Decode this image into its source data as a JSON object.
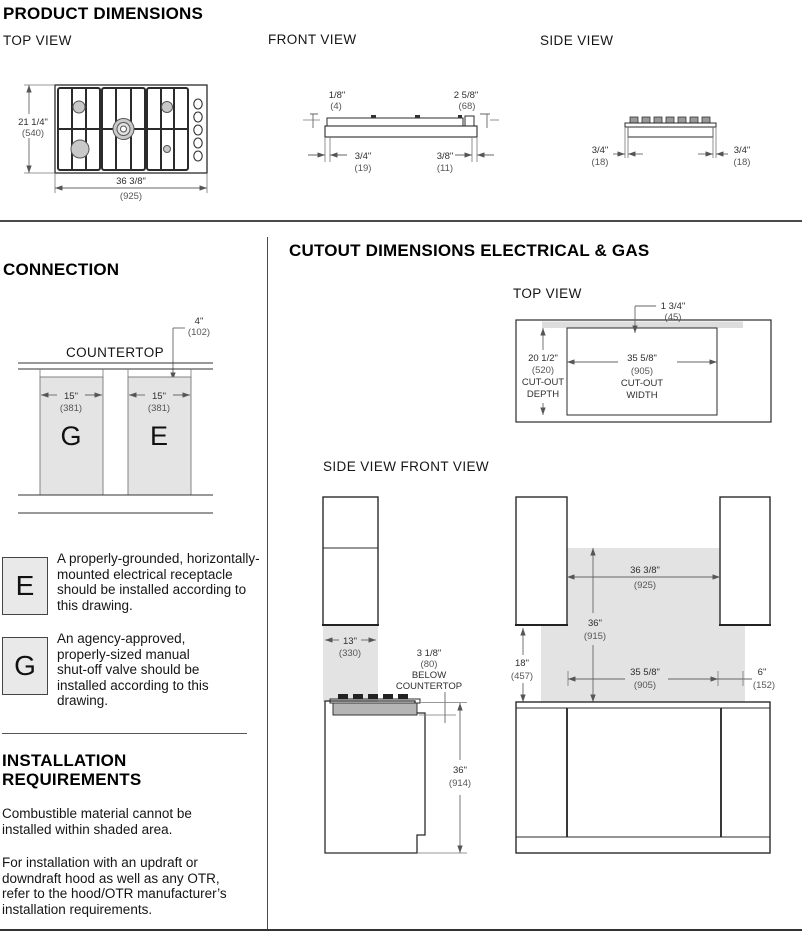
{
  "titles": {
    "product": "PRODUCT DIMENSIONS",
    "connection": "CONNECTION",
    "cutout": "CUTOUT DIMENSIONS ELECTRICAL & GAS",
    "installation": "INSTALLATION REQUIREMENTS"
  },
  "view_labels": {
    "product_top": "TOP VIEW",
    "product_front": "FRONT VIEW",
    "product_side": "SIDE VIEW",
    "cutout_top": "TOP VIEW",
    "cutout_side_front": "SIDE VIEW FRONT VIEW"
  },
  "product_top": {
    "depth_in": "21 1/4\"",
    "depth_mm": "(540)",
    "width_in": "36 3/8\"",
    "width_mm": "(925)"
  },
  "product_front": {
    "lip_in": "1/8\"",
    "lip_mm": "(4)",
    "knob_in": "2 5/8\"",
    "knob_mm": "(68)",
    "left_in": "3/4\"",
    "left_mm": "(19)",
    "right_in": "3/8\"",
    "right_mm": "(11)"
  },
  "product_side": {
    "left_in": "3/4\"",
    "left_mm": "(18)",
    "right_in": "3/4\"",
    "right_mm": "(18)"
  },
  "connection": {
    "countertop": "COUNTERTOP",
    "offset_in": "4\"",
    "offset_mm": "(102)",
    "gas_letter": "G",
    "gas_width_in": "15\"",
    "gas_width_mm": "(381)",
    "elec_letter": "E",
    "elec_width_in": "15\"",
    "elec_width_mm": "(381)"
  },
  "cutout_top": {
    "rear_in": "1 3/4\"",
    "rear_mm": "(45)",
    "depth_in": "20 1/2\"",
    "depth_mm": "(520)",
    "depth_label1": "CUT-OUT",
    "depth_label2": "DEPTH",
    "width_in": "35 5/8\"",
    "width_mm": "(905)",
    "width_label1": "CUT-OUT",
    "width_label2": "WIDTH"
  },
  "cutout_side": {
    "cabinet_depth_in": "13\"",
    "cabinet_depth_mm": "(330)",
    "below_in": "3 1/8\"",
    "below_mm": "(80)",
    "below_label1": "BELOW",
    "below_label2": "COUNTERTOP",
    "height_in": "36\"",
    "height_mm": "(914)"
  },
  "cutout_front": {
    "clearance_in": "18\"",
    "clearance_mm": "(457)",
    "width_in": "36 3/8\"",
    "width_mm": "(925)",
    "backsplash_in": "36\"",
    "backsplash_mm": "(915)",
    "cut_width_in": "35 5/8\"",
    "cut_width_mm": "(905)",
    "side_in": "6\"",
    "side_mm": "(152)"
  },
  "legend": [
    {
      "letter": "E",
      "text": "A properly-grounded, horizontally-mounted electrical receptacle should be installed according to this drawing."
    },
    {
      "letter": "G",
      "text": "An agency-approved, properly-sized manual shut-off valve should be installed according to this drawing."
    }
  ],
  "installation": {
    "p1": "Combustible material cannot be installed within shaded area.",
    "p2": "For installation with an updraft or downdraft hood as well as any OTR, refer to the hood/OTR manufacturer’s installation requirements."
  }
}
